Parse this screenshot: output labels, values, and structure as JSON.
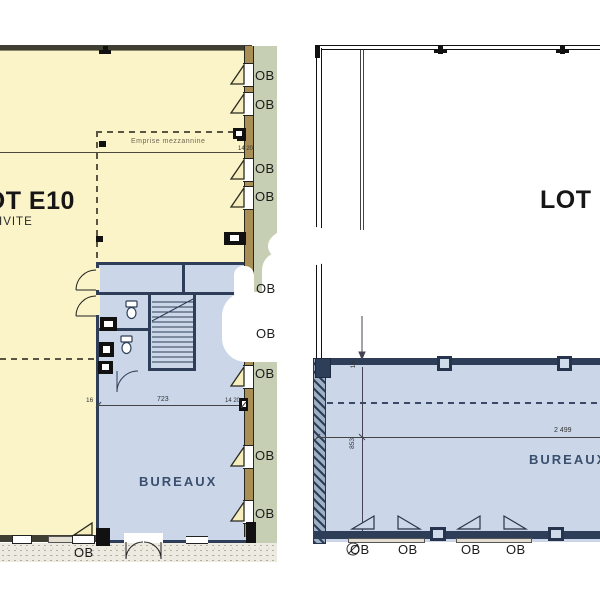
{
  "left_plan": {
    "lot_label": "LOT E10",
    "zone_label": "ACTIVITE",
    "room_label": "BUREAUX",
    "mezzanine_label": "Emprise mezzannine",
    "mezzanine_dim": "14 20",
    "dim_wall_left": "16",
    "dim_width": "723",
    "dim_wall_right": "14 20",
    "window_label": "OB"
  },
  "right_plan": {
    "lot_label": "LOT E",
    "room_label": "BUREAUX",
    "dim_width": "2 499",
    "dim_depth": "853",
    "dim_wall": "16",
    "window_label": "OB"
  },
  "colors": {
    "activity_fill": "#fbf4c8",
    "office_fill": "#cbd7e8",
    "office_wall": "#2e3e59",
    "facade_wall_tan": "#a98f55",
    "green_strip": "#c6cfb3"
  }
}
